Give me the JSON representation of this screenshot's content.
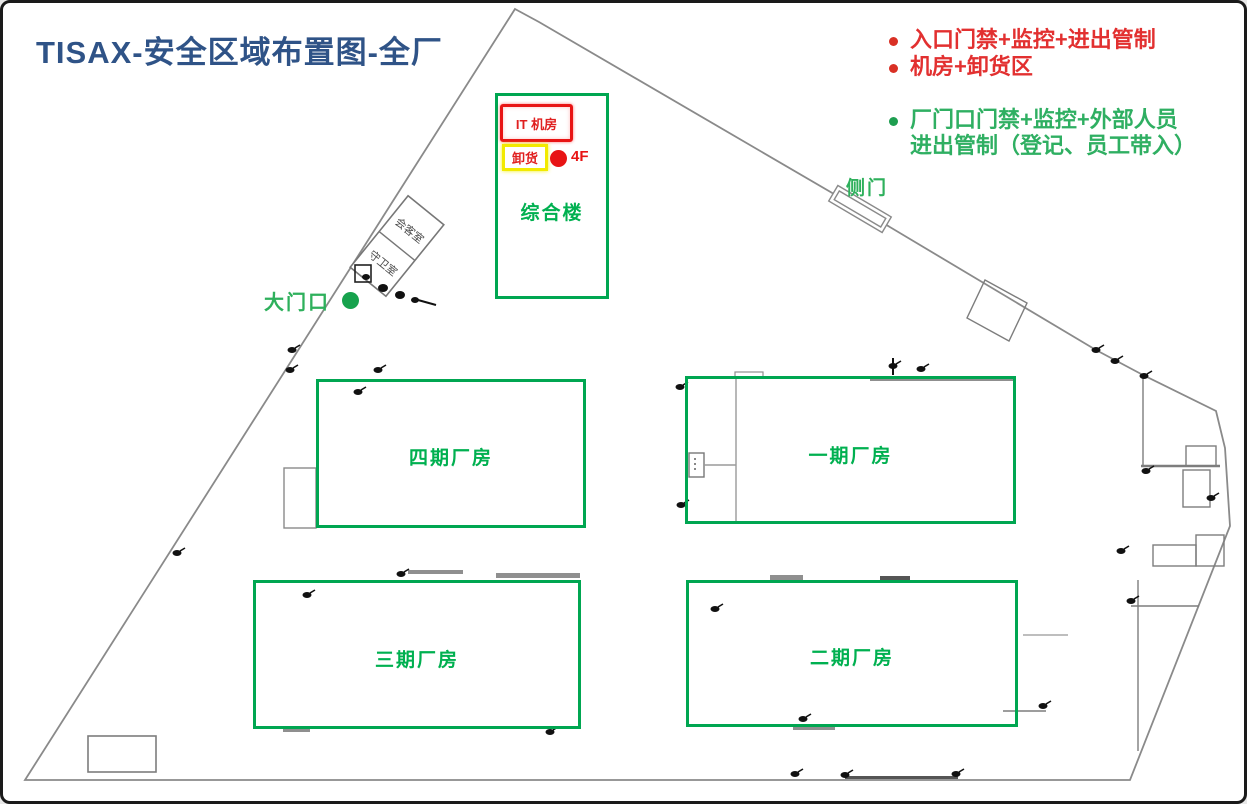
{
  "title": "TISAX-安全区域布置图-全厂",
  "legend": {
    "items": [
      {
        "label": "入口门禁+监控+进出管制",
        "color": "#E23030"
      },
      {
        "label": "机房+卸货区",
        "color": "#E23030"
      },
      {
        "label": "厂门口门禁+监控+外部人员",
        "label2": "进出管制（登记、员工带入）",
        "color": "#2FAF62"
      }
    ]
  },
  "buildings": {
    "complex": {
      "label": "综合楼"
    },
    "phase4": {
      "label": "四期厂房"
    },
    "phase1": {
      "label": "一期厂房"
    },
    "phase3": {
      "label": "三期厂房"
    },
    "phase2": {
      "label": "二期厂房"
    }
  },
  "markers": {
    "it_room": "IT 机房",
    "unloading": "卸货",
    "floor": "4F",
    "main_gate": "大门口",
    "side_gate": "侧门",
    "meeting_room": "会客室",
    "guard_room": "守卫室"
  },
  "colors": {
    "title": "#2F5387",
    "red": "#E23030",
    "green_text": "#00B050",
    "green_border": "#00A651",
    "yellow": "#F2EA00",
    "outline_gray": "#8A8A8A"
  }
}
